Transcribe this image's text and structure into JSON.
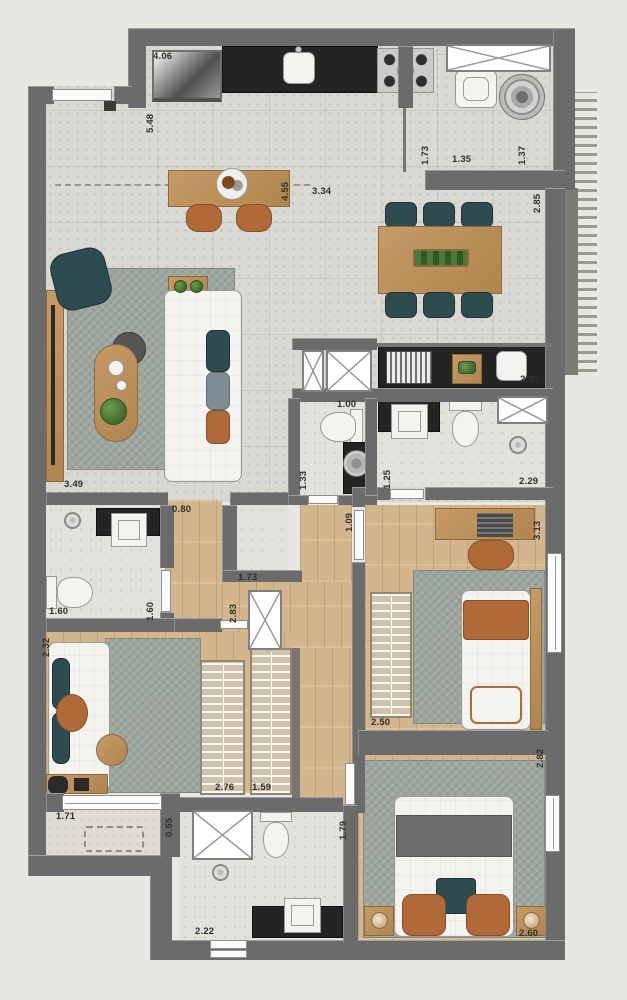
{
  "palette": {
    "outside": "#e9e7e2",
    "wall": "#6b6b6b",
    "concrete": "#d9d8d3",
    "tile": "#e3e1dc",
    "wood": "#d3b68d",
    "furniture_wood": "#c59a66",
    "counter": "#242424",
    "fixture": "#f4f3f0",
    "teal": "#2e4b50",
    "slate": "#7e8d95",
    "orange": "#b06a38",
    "rug": "#9da69f",
    "label_ink": "#32302b"
  },
  "dimension_labels": [
    {
      "text": "4.06",
      "x": 153,
      "y": 52,
      "v": false
    },
    {
      "text": "5.48",
      "x": 146,
      "y": 133,
      "v": true
    },
    {
      "text": "4.55",
      "x": 281,
      "y": 201,
      "v": true
    },
    {
      "text": "3.34",
      "x": 312,
      "y": 187,
      "v": false
    },
    {
      "text": "1.73",
      "x": 421,
      "y": 165,
      "v": true
    },
    {
      "text": "1.35",
      "x": 452,
      "y": 155,
      "v": false
    },
    {
      "text": "1.37",
      "x": 518,
      "y": 165,
      "v": true
    },
    {
      "text": "2.85",
      "x": 533,
      "y": 213,
      "v": true
    },
    {
      "text": "2.33",
      "x": 520,
      "y": 375,
      "v": false
    },
    {
      "text": "3.49",
      "x": 64,
      "y": 480,
      "v": false
    },
    {
      "text": "1.00",
      "x": 337,
      "y": 400,
      "v": false
    },
    {
      "text": "1.33",
      "x": 299,
      "y": 490,
      "v": true
    },
    {
      "text": "1.25",
      "x": 383,
      "y": 489,
      "v": true
    },
    {
      "text": "2.29",
      "x": 519,
      "y": 477,
      "v": false
    },
    {
      "text": "1.09",
      "x": 345,
      "y": 532,
      "v": true
    },
    {
      "text": "0.80",
      "x": 172,
      "y": 505,
      "v": false
    },
    {
      "text": "1.73",
      "x": 238,
      "y": 573,
      "v": false
    },
    {
      "text": "2.83",
      "x": 229,
      "y": 623,
      "v": true
    },
    {
      "text": "1.60",
      "x": 49,
      "y": 607,
      "v": false
    },
    {
      "text": "1.60",
      "x": 146,
      "y": 621,
      "v": true
    },
    {
      "text": "3.13",
      "x": 533,
      "y": 540,
      "v": true
    },
    {
      "text": "2.50",
      "x": 371,
      "y": 718,
      "v": false
    },
    {
      "text": "2.32",
      "x": 42,
      "y": 657,
      "v": true
    },
    {
      "text": "2.76",
      "x": 215,
      "y": 783,
      "v": false
    },
    {
      "text": "1.59",
      "x": 252,
      "y": 783,
      "v": false
    },
    {
      "text": "1.71",
      "x": 56,
      "y": 812,
      "v": false
    },
    {
      "text": "0.55",
      "x": 165,
      "y": 837,
      "v": true
    },
    {
      "text": "1.79",
      "x": 339,
      "y": 840,
      "v": true
    },
    {
      "text": "2.22",
      "x": 195,
      "y": 927,
      "v": false
    },
    {
      "text": "2.82",
      "x": 536,
      "y": 768,
      "v": true
    },
    {
      "text": "2.60",
      "x": 519,
      "y": 929,
      "v": false
    }
  ]
}
